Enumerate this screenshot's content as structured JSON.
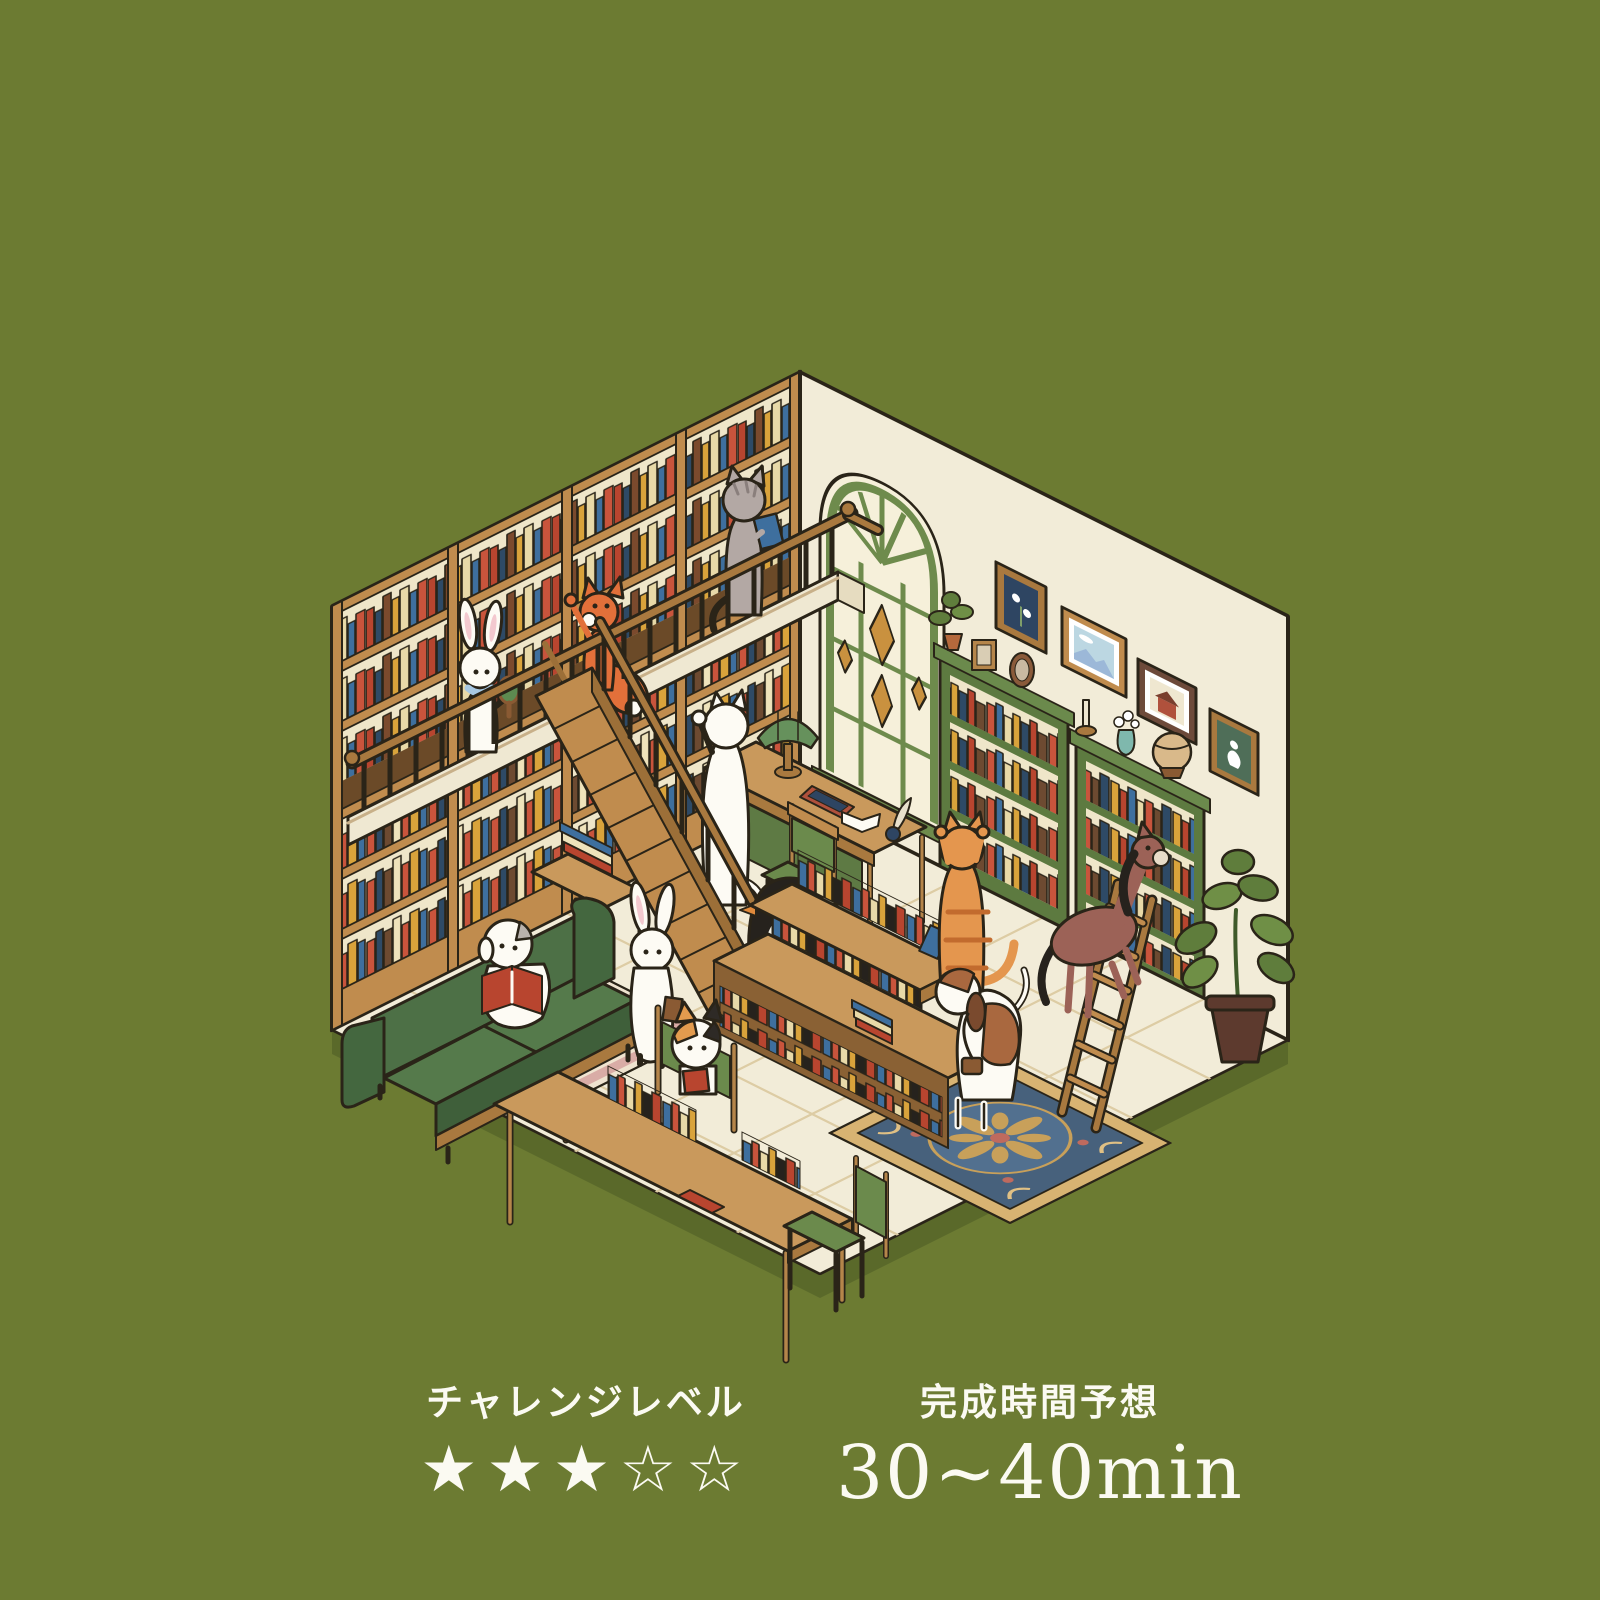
{
  "header": {
    "scene_label": "SCENE #01",
    "title": "図書館",
    "banner_bg": "#ffffff",
    "title_color": "#6c7b32"
  },
  "footer": {
    "challenge": {
      "label": "チャレンジレベル",
      "stars": "★★★☆☆",
      "stars_filled": 3,
      "stars_total": 5
    },
    "time": {
      "label": "完成時間予想",
      "value": "30~40min"
    }
  },
  "palette": {
    "background": "#6c7b32",
    "background_shadow": "#5a692a",
    "text_white": "#fbfaf2",
    "wall_cream": "#f2ecd8",
    "wood": "#c08c4e",
    "wood_dark": "#9c6f38",
    "shelf_green": "#5d7a40",
    "sofa_green": "#4d7046",
    "window_green": "#6e8b4c",
    "book_red": "#c9543c",
    "book_blue": "#3e6f9e",
    "book_yellow": "#d9a33b",
    "book_cream": "#e8d9a8",
    "rug_pink_border": "#d9aca6",
    "rug_navy": "#47617c",
    "rug_gold": "#d8b372",
    "outline": "#2a2418"
  }
}
